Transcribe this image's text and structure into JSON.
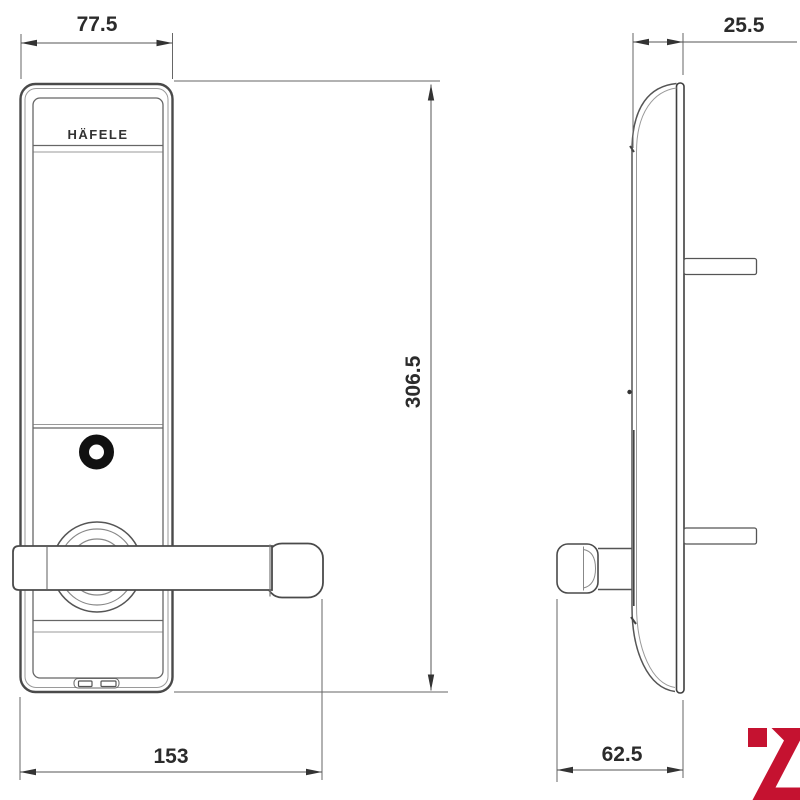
{
  "page": {
    "background": "#ffffff"
  },
  "drawing": {
    "brand_label": "HÄFELE",
    "dimensions": {
      "front_width": {
        "value": "77.5"
      },
      "front_height": {
        "value": "306.5"
      },
      "handle_span": {
        "value": "153"
      },
      "side_top_depth": {
        "value": "25.5"
      },
      "side_bottom_depth": {
        "value": "62.5"
      }
    },
    "colors": {
      "outline": "#4a4a4a",
      "outline_light": "#9a9a9a",
      "dim_line": "#555555",
      "dim_text": "#2b2b2b",
      "watermark": "#c51230"
    }
  }
}
